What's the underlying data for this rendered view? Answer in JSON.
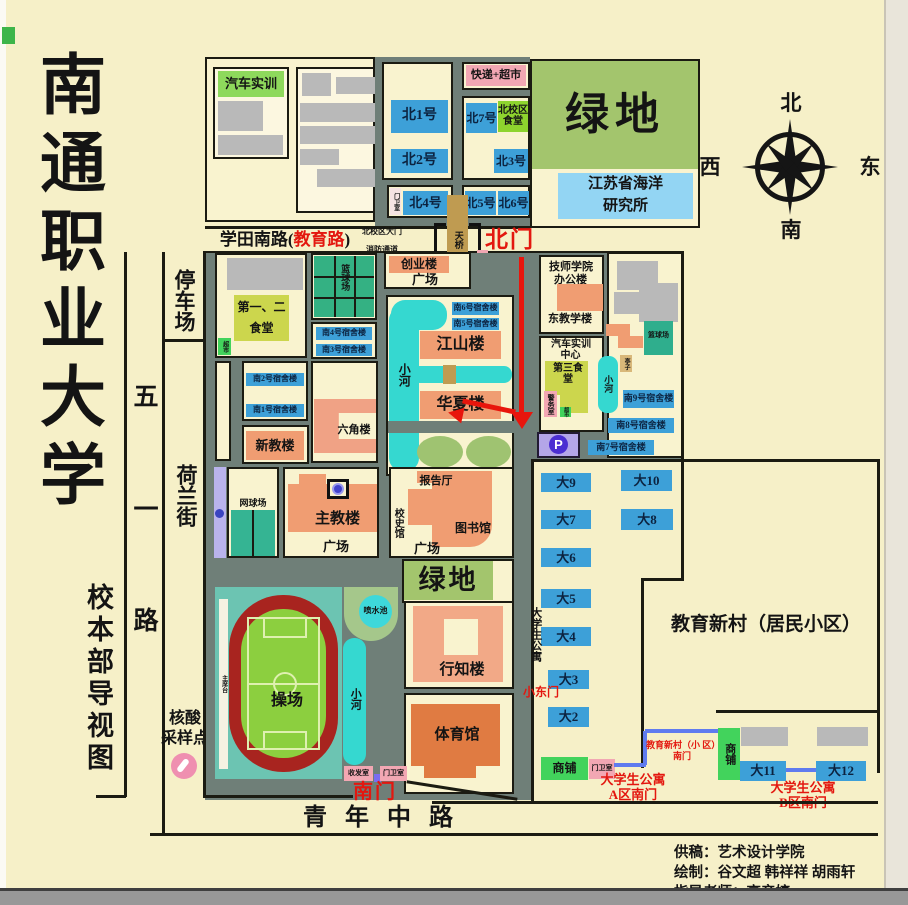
{
  "title": {
    "school": "南通职业大学",
    "map": "校本部导视图"
  },
  "compass": {
    "n": "北",
    "e": "东",
    "s": "南",
    "w": "西"
  },
  "streets": {
    "xuetian_black1": "学田南路(",
    "xuetian_red": "教育路",
    "xuetian_black2": ")",
    "qingnian": "青年中路",
    "wuyi1": "五",
    "wuyi2": "一",
    "wuyi3": "路",
    "helan": "荷兰街",
    "parking_lot": "停车场",
    "north_gate_road": "北校区大门",
    "fire_lane": "消防通道",
    "student_apartment_road": "大学生公寓"
  },
  "gates": {
    "north": "北门",
    "south": "南门",
    "east_small": "小东门",
    "bridge": "天桥",
    "a_line1": "大学生公寓",
    "a_line2": "A区南门",
    "b_line1": "大学生公寓",
    "b_line2": "B区南门",
    "xincun_line1": "教育新村（小 区）",
    "xincun_line2": "南门"
  },
  "north_blocks": {
    "auto_training": "汽车实训",
    "express_super": "快递+超市",
    "north_canteen": "北校区食堂",
    "b1": "北1号",
    "b2": "北2号",
    "b3": "北3号",
    "b4": "北4号",
    "b5": "北5号",
    "b6": "北6号",
    "b7": "北7号",
    "green_space": "绿地",
    "marine_line1": "江苏省海洋",
    "marine_line2": "研究所",
    "guard": "门卫室"
  },
  "campus": {
    "canteen12_l1": "第一、二",
    "canteen12_l2": "食堂",
    "supermarket": "超市",
    "basketball_w": "篮球场",
    "s1": "南1号宿舍楼",
    "s2": "南2号宿舍楼",
    "s3": "南3号宿舍楼",
    "s4": "南4号宿舍楼",
    "s5": "南5号宿舍楼",
    "s6": "南6号宿舍楼",
    "s7": "南7号宿舍楼",
    "s8": "南8号宿舍楼",
    "s9": "南9号宿舍楼",
    "new_teaching": "新教楼",
    "hexagon": "六角楼",
    "chuangye": "创业楼",
    "plaza1": "广场",
    "plaza2": "广场",
    "plaza3": "广场",
    "river": "小河",
    "river2": "小河",
    "river3": "小河",
    "jiangshan": "江山楼",
    "huaxia": "华夏楼",
    "tech_office_l1": "技师学院",
    "tech_office_l2": "办公楼",
    "east_teaching": "东教学楼",
    "auto_center_l1": "汽车实训",
    "auto_center_l2": "中心",
    "canteen3": "第三食堂",
    "police": "警务室",
    "basketball_e": "篮球场",
    "pavilion": "亭子",
    "main_building": "主教楼",
    "tennis": "网球场",
    "report_hall": "报告厅",
    "history_hall": "校史馆",
    "library": "图书馆",
    "green_space2": "绿地",
    "fountain": "喷水池",
    "playground": "操场",
    "stage": "主席台",
    "xingzhi": "行知楼",
    "gym": "体育馆",
    "parking_p": "P"
  },
  "east": {
    "d2": "大2",
    "d3": "大3",
    "d4": "大4",
    "d5": "大5",
    "d6": "大6",
    "d7": "大7",
    "d8": "大8",
    "d9": "大9",
    "d10": "大10",
    "d11": "大11",
    "d12": "大12",
    "community": "教育新村（居民小区）",
    "shop_a": "商铺",
    "shop_b": "商铺",
    "guard_a": "门卫室"
  },
  "south": {
    "mail_room": "收发室",
    "guard_room": "门卫室"
  },
  "covid": {
    "l1": "核酸",
    "l2": "采样点"
  },
  "credits": {
    "l1": "供稿：艺术设计学院",
    "l2": "绘制：谷文超  韩祥祥  胡雨轩",
    "l3": "指导老师：高彦婷"
  }
}
